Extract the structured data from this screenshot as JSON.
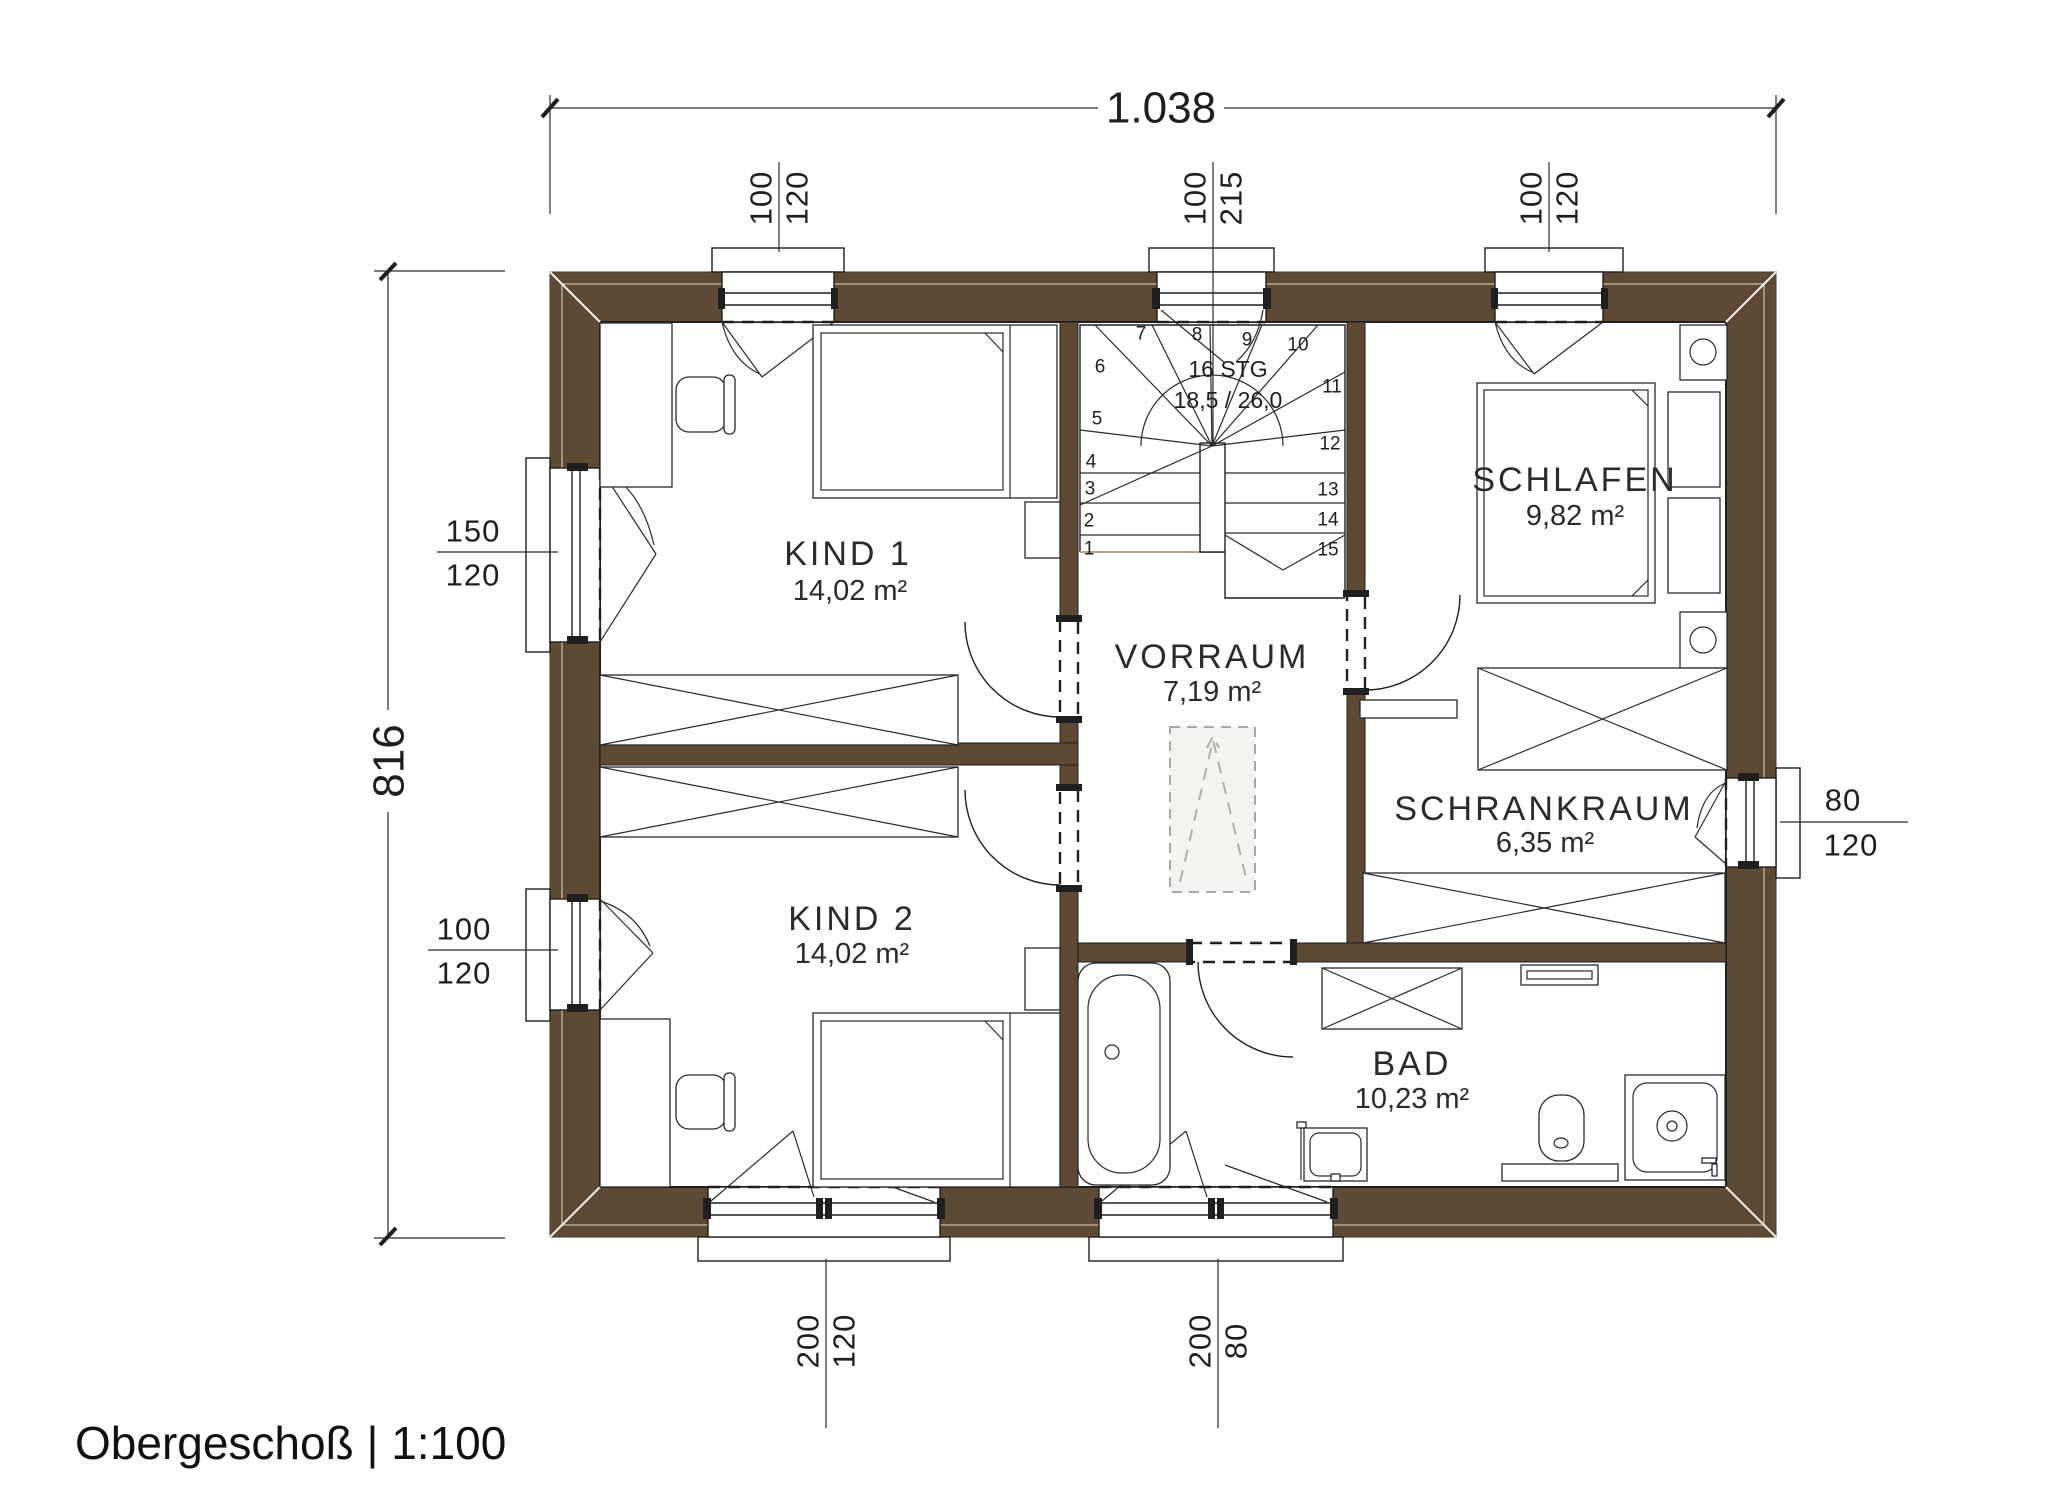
{
  "title": "Obergeschoß | 1:100",
  "colors": {
    "wall_brown": "#5d4934",
    "line_dark": "#1f1f1f",
    "accent_light": "#b3a48e"
  },
  "dimensions": {
    "overall_width": "1.038",
    "overall_height": "816",
    "top": [
      {
        "width": "100",
        "height": "120"
      },
      {
        "width": "100",
        "height": "215"
      },
      {
        "width": "100",
        "height": "120"
      }
    ],
    "left": [
      {
        "width": "150",
        "height": "120"
      },
      {
        "width": "100",
        "height": "120"
      }
    ],
    "right": [
      {
        "width": "80",
        "height": "120"
      }
    ],
    "bottom": [
      {
        "width": "200",
        "height": "120"
      },
      {
        "width": "200",
        "height": "80"
      }
    ]
  },
  "rooms": [
    {
      "name": "KIND 1",
      "area": "14,02 m²"
    },
    {
      "name": "KIND 2",
      "area": "14,02 m²"
    },
    {
      "name": "VORRAUM",
      "area": "7,19 m²"
    },
    {
      "name": "SCHLAFEN",
      "area": "9,82 m²"
    },
    {
      "name": "SCHRANKRAUM",
      "area": "6,35 m²"
    },
    {
      "name": "BAD",
      "area": "10,23 m²"
    }
  ],
  "stair": {
    "steps_label": "16 STG",
    "rise_run_label": "18,5 / 26,0",
    "step_numbers": [
      "1",
      "2",
      "3",
      "4",
      "5",
      "6",
      "7",
      "8",
      "9",
      "10",
      "11",
      "12",
      "13",
      "14",
      "15"
    ]
  }
}
